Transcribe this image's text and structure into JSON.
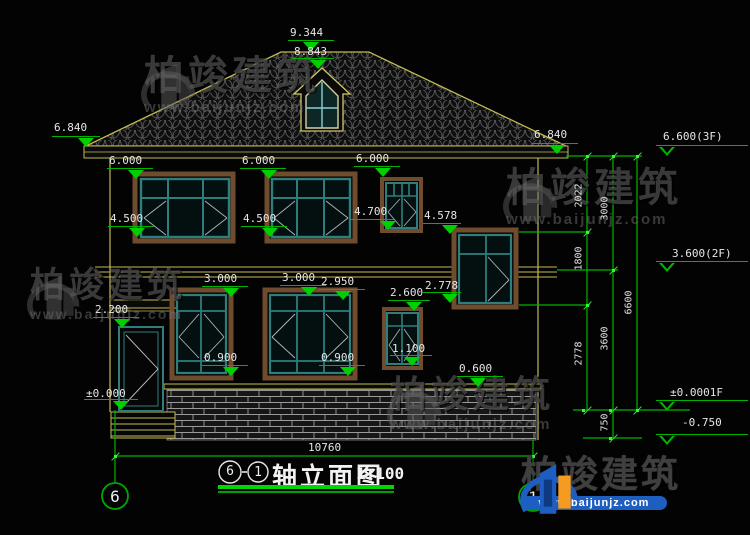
{
  "colors": {
    "background": "#030303",
    "cad_yellow": "#c3ba54",
    "dim_green": "#00b400",
    "bright_green": "#2bff2b",
    "window_teal": "#2f7d7d",
    "frame_brown": "#6f4c2e",
    "text_white": "#e6e6e6",
    "logo_blue": "#1d5ec0",
    "logo_orange": "#f59b20"
  },
  "watermark": {
    "brand": "柏竣建筑",
    "url": "www.baijunjz.com"
  },
  "footer_logo": {
    "brand": "柏竣建筑",
    "url": "www.baijunjz.com"
  },
  "title_bar": {
    "axis_start": "6",
    "axis_end": "1",
    "name": "轴立面图",
    "scale": "1:100"
  },
  "axis_bubbles": {
    "left": "6",
    "right": "1"
  },
  "dims": {
    "total_width": "10760",
    "v1_top": "2022",
    "v1_mid": "1800",
    "v1_bot": "2778",
    "v2_top": "3000",
    "v2_mid": "3600",
    "v2_bot": "750",
    "v3": "6600"
  },
  "levels": {
    "ridge": "9.344",
    "dormer": "8.843",
    "eave_left": "6.840",
    "eave_right": "6.840",
    "f3": "6.600(3F)",
    "f2": "3.600(2F)",
    "f1": "±0.0001F",
    "ground": "-0.750",
    "w2a_top": "6.000",
    "w2b_top": "6.000",
    "w2c_top": "6.000",
    "w2a_sill": "4.500",
    "w2b_sill": "4.500",
    "w2c_sill": "4.700",
    "stair_top": "4.578",
    "w1a_top": "3.000",
    "w1b_top": "3.000",
    "w1b_lintel": "2.950",
    "w1c_top": "2.600",
    "stair_sill": "2.778",
    "door_top": "2.200",
    "w1a_sill": "0.900",
    "w1b_sill": "0.900",
    "w1c_sill": "1.100",
    "plinth": "0.600",
    "zero": "±0.000"
  }
}
